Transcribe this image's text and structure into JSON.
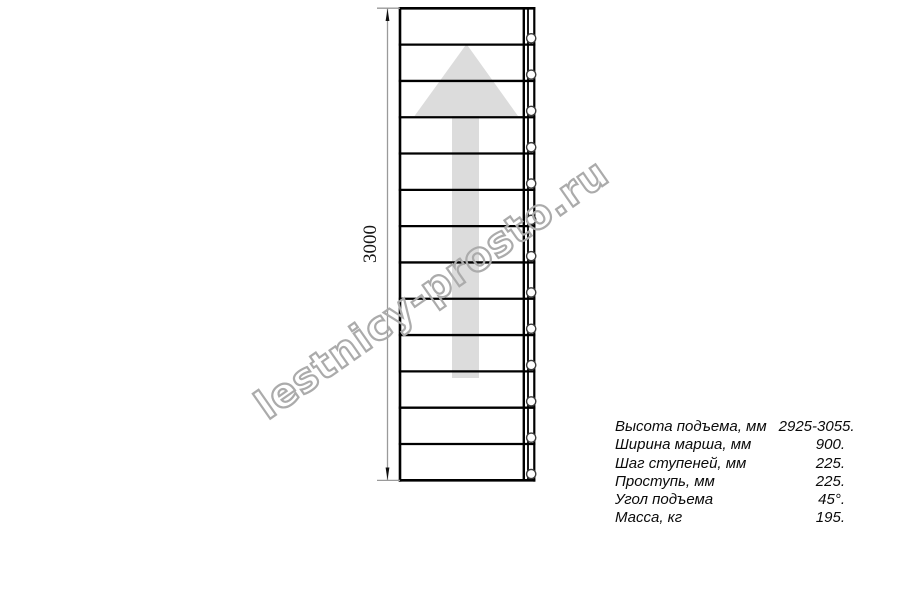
{
  "diagram": {
    "title": "staircase-plan-top-view",
    "dimension_label": "3000",
    "step_count": 13,
    "hole_count": 13,
    "colors": {
      "line": "#000000",
      "arrow_fill": "#dcdcdc",
      "dimension_line": "#9a9a9a",
      "hole_stroke": "#3c3c3c"
    }
  },
  "watermark": {
    "text": "lestnicy-prosto.ru",
    "color": "#ababab"
  },
  "specs": {
    "rows": [
      {
        "label": "Высота подъема, мм",
        "value": "2925-3055."
      },
      {
        "label": "Ширина марша, мм",
        "value": "900."
      },
      {
        "label": "Шаг ступеней, мм",
        "value": "225."
      },
      {
        "label": "Проступь, мм",
        "value": "225."
      },
      {
        "label": "Угол подъема",
        "value": "45°."
      },
      {
        "label": "Масса, кг",
        "value": "195."
      }
    ]
  }
}
